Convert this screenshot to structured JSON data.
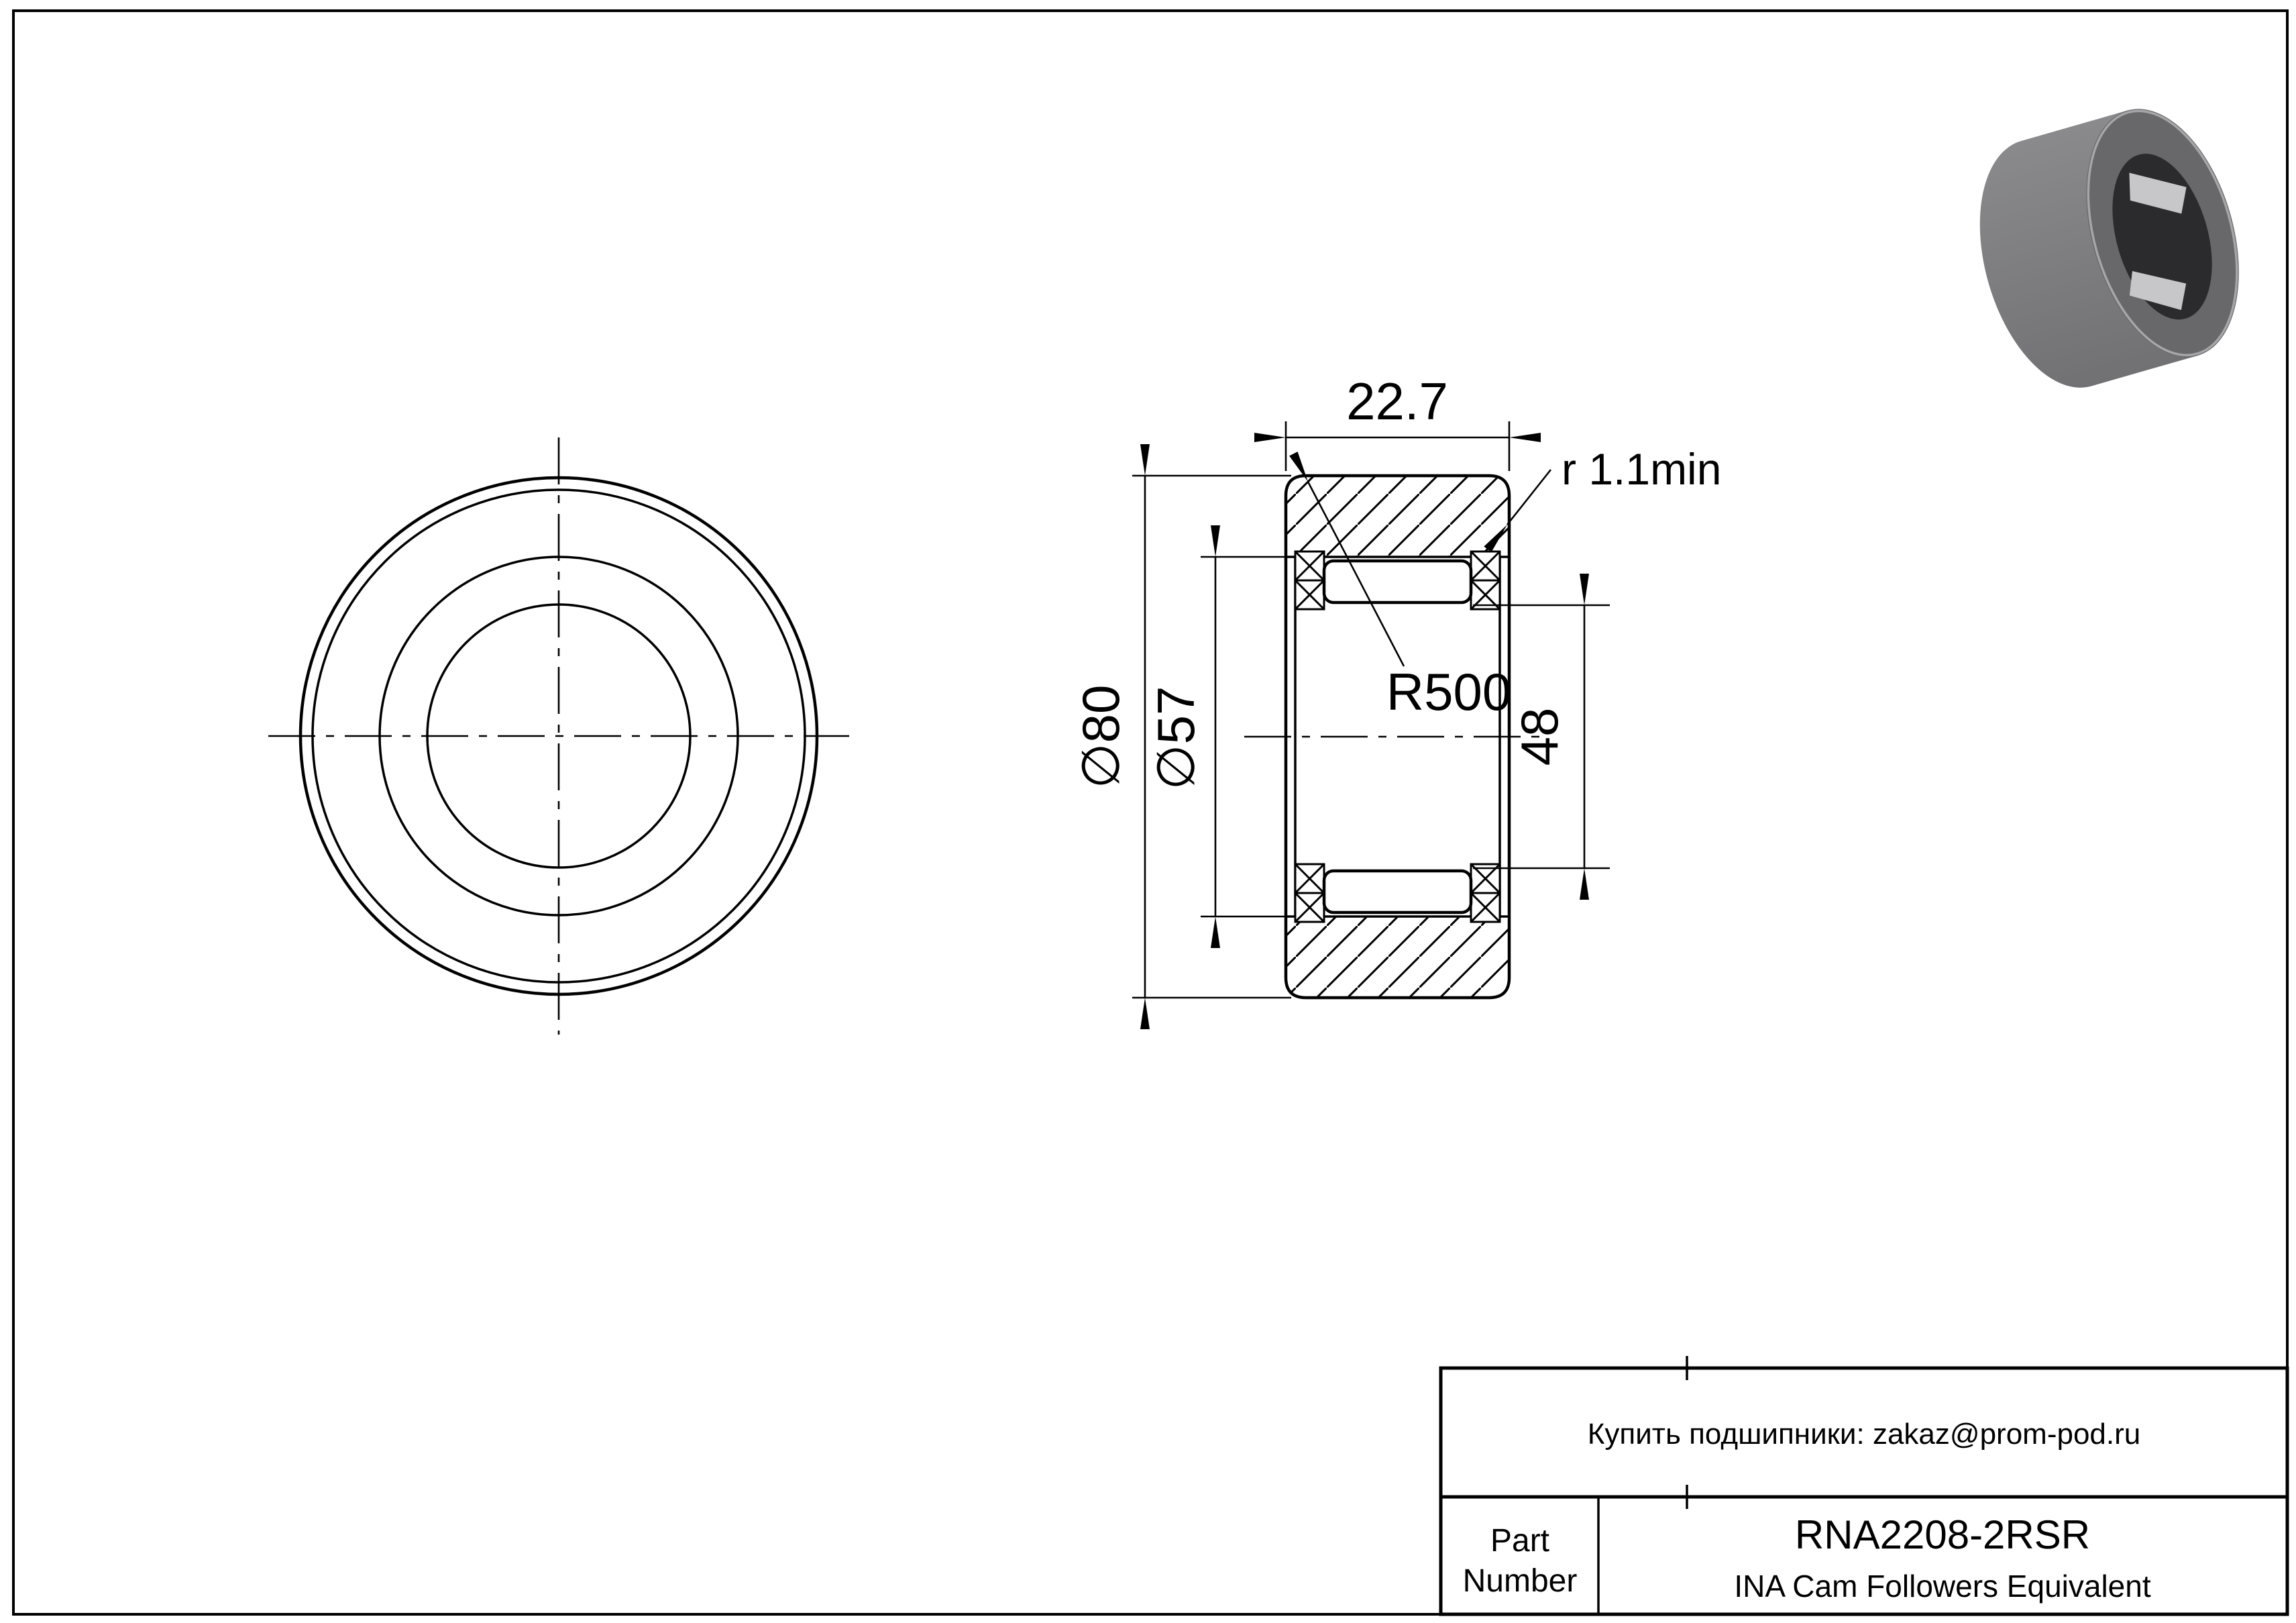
{
  "dimensions": {
    "width": "22.7",
    "outer_diameter": "∅80",
    "raceway_diameter": "∅57",
    "under_roller_diameter": "48",
    "crown_radius": "R500",
    "corner_radius": "r 1.1min"
  },
  "title_block": {
    "contact": "Купить подшипники: zakaz@prom-pod.ru",
    "part_label_line1": "Part",
    "part_label_line2": "Number",
    "part_number": "RNA2208-2RSR",
    "equivalent": "INA Cam Followers Equivalent"
  },
  "render3d": {
    "body_color_top": "#8a8a8d",
    "body_color_bottom": "#717174",
    "face_color": "#68686b",
    "rim_highlight_color": "#a6a6a9",
    "bore_color": "#2b2b2d",
    "roller_highlight_color": "#c7c7ca"
  },
  "page": {
    "background": "#ffffff",
    "line_color": "#000000"
  }
}
